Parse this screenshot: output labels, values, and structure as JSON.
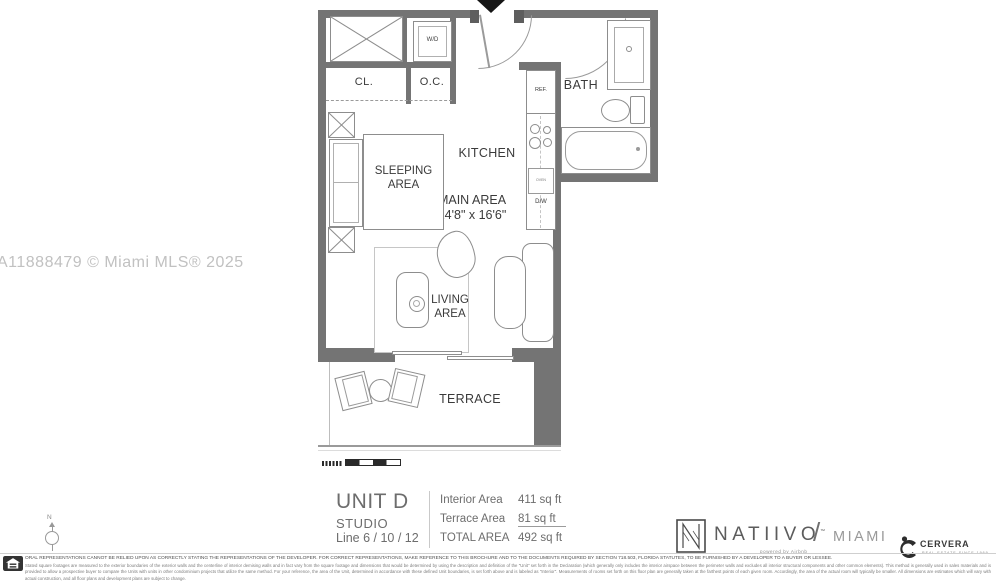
{
  "watermark": "A11888479 © Miami MLS® 2025",
  "colors": {
    "wall": "#747474",
    "plan_line": "#8d8d8d",
    "label_text": "#3a3a3a",
    "muted_text": "#6d6d6d",
    "watermark_text": "#c1c1c1"
  },
  "plan": {
    "labels": {
      "washer_dryer": "W/D",
      "closet": "CL.",
      "other_closet": "O.C.",
      "bath": "BATH",
      "refrigerator": "REF.",
      "oven": "OVEN",
      "dishwasher": "D/W",
      "kitchen": "KITCHEN",
      "sleeping_area": "SLEEPING AREA",
      "main_area": "MAIN AREA",
      "main_area_dimensions": "14'8\" x 16'6\"",
      "living_area": "LIVING AREA",
      "terrace": "TERRACE"
    }
  },
  "unit_info": {
    "name": "UNIT D",
    "type": "STUDIO",
    "line": "Line 6 / 10 / 12",
    "areas": [
      {
        "label": "Interior Area",
        "value": "411 sq ft"
      },
      {
        "label": "Terrace Area",
        "value": "81 sq ft"
      },
      {
        "label": "TOTAL AREA",
        "value": "492 sq ft"
      }
    ]
  },
  "branding": {
    "nativo_name": "NATIIVO",
    "nativo_tm": "™",
    "separator": "/",
    "city": "MIAMI",
    "powered_by": "powered by Airbnb",
    "cervera_name": "CERVERA",
    "cervera_tagline": "REAL ESTATE SINCE 1969"
  },
  "compass": {
    "north_label": "N"
  },
  "footer": {
    "disclaimer_line1": "ORAL REPRESENTATIONS CANNOT BE RELIED UPON AS CORRECTLY STATING THE REPRESENTATIONS OF THE DEVELOPER. FOR CORRECT REPRESENTATIONS, MAKE REFERENCE TO THIS BROCHURE AND TO THE DOCUMENTS REQUIRED BY SECTION 718.503, FLORIDA STATUTES, TO BE FURNISHED BY A DEVELOPER TO A BUYER OR LESSEE.",
    "disclaimer_body": "Stated square footages are measured to the exterior boundaries of the exterior walls and the centerline of interior demising walls and in fact vary from the square footage and dimensions that would be determined by using the description and definition of the \"Unit\" set forth in the Declaration (which generally only includes the interior airspace between the perimeter walls and excludes all interior structural components and other common elements). This method is generally used in sales materials and is provided to allow a prospective buyer to compare the Units with units in other condominium projects that utilize the same method. For your reference, the area of the Unit, determined in accordance with these defined Unit boundaries, is set forth above and is labeled as \"Interior\". Measurements of rooms set forth on this floor plan are generally taken at the farthest points of each given room. Accordingly, the area of the actual room will typically be smaller. All dimensions are estimates which will vary with actual construction, and all floor plans and development plans are subject to change."
  }
}
